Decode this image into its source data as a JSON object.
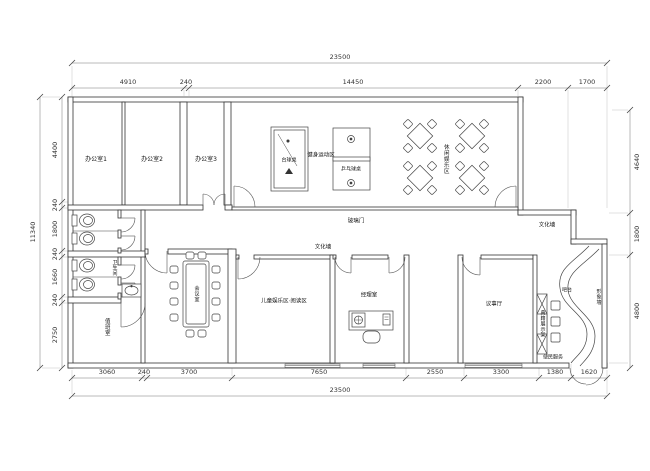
{
  "plan": {
    "rooms": {
      "office1": "办公室1",
      "office2": "办公室2",
      "office3": "办公室3",
      "restroom": "卫生间",
      "duty_room": "值班室",
      "meeting_room": "会议室",
      "kids_reading_zone": "儿童娱乐区·阅读区",
      "manager_office": "经理室",
      "council_hall": "议事厅",
      "leisure_zone": "休闲娱乐区",
      "fitness_zone": "健身运动区"
    },
    "features": {
      "billiard_table": "台球桌",
      "pingpong_table": "乒乓球桌",
      "glass_door": "玻璃门",
      "culture_wall_center": "文化墙",
      "culture_wall_right": "文化墙",
      "bar_counter": "吧台",
      "image_wall": "形象墙",
      "display_shelf": "典籍展示架",
      "convenience_service": "便民服务"
    },
    "dimensions": {
      "top_total": "23500",
      "top_chain": [
        "4910",
        "240",
        "14450",
        "2200",
        "1700"
      ],
      "bottom_chain": [
        "3060",
        "240",
        "3700",
        "7650",
        "2550",
        "3300",
        "1380",
        "1620"
      ],
      "bottom_total": "23500",
      "left_total": "11340",
      "left_chain": [
        "4400",
        "240",
        "1800",
        "240",
        "1660",
        "240",
        "2750"
      ],
      "right_chain": [
        "4640",
        "1800",
        "4800"
      ]
    }
  }
}
